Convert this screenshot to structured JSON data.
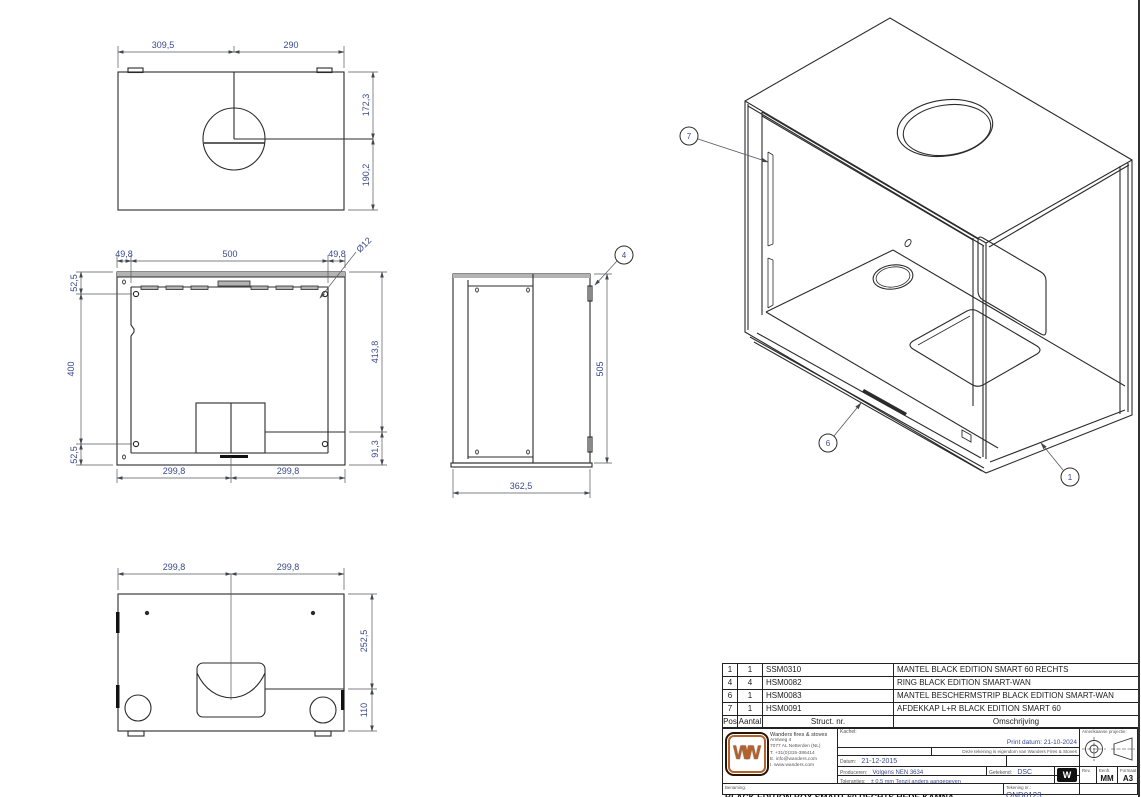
{
  "views": {
    "top": {
      "w_left": "309,5",
      "w_right": "290",
      "h_top": "172,3",
      "h_bottom": "190,2"
    },
    "front": {
      "top_left": "49,8",
      "top_center": "500",
      "top_right": "49,8",
      "hole": "Ø12",
      "left_top": "52,5",
      "left_mid": "400",
      "left_bottom": "52,5",
      "right_top": "413,8",
      "right_bottom": "91,3",
      "bottom_left": "299,8",
      "bottom_right": "299,8"
    },
    "side": {
      "height": "505",
      "width": "362,5",
      "callout_4": "4"
    },
    "bottom": {
      "top_left": "299,8",
      "top_right": "299,8",
      "right_top": "252,5",
      "right_bottom": "110"
    },
    "iso": {
      "callout_7": "7",
      "callout_6": "6",
      "callout_1": "1"
    }
  },
  "parts_table": {
    "headers": {
      "pos": "Pos",
      "qty": "Aantal",
      "struct": "Struct. nr.",
      "desc": "Omschrijving"
    },
    "rows": [
      {
        "pos": "1",
        "qty": "1",
        "struct": "SSM0310",
        "desc": "MANTEL BLACK EDITION SMART 60 RECHTS"
      },
      {
        "pos": "4",
        "qty": "4",
        "struct": "HSM0082",
        "desc": "RING BLACK EDITION SMART-WAN"
      },
      {
        "pos": "6",
        "qty": "1",
        "struct": "HSM0083",
        "desc": "MANTEL BESCHERMSTRIP BLACK EDITION SMART-WAN"
      },
      {
        "pos": "7",
        "qty": "1",
        "struct": "HSM0091",
        "desc": "AFDEKKAP L+R BLACK EDITION SMART 60"
      }
    ]
  },
  "title_block": {
    "company": {
      "name": "Wanders fires & stoves",
      "address1": "Amtweg 4",
      "address2": "7077 AL Netterden (NL)",
      "phone": "T. +31(0)315-386414",
      "email": "E. info@wanders.com",
      "web": "I. www.wanders.com",
      "logo_text": "WW"
    },
    "kachel_label": "Kachel:",
    "print_date": "Print datum: 21-10-2024",
    "ownership": "Deze tekening is eigendom van Wanders Fires & Stoves",
    "datum_label": "Datum:",
    "datum_value": "21-12-2015",
    "produceren_label": "Produceren:",
    "produceren_value": "Volgens NEN 3634",
    "getekend_label": "Getekend:",
    "getekend_value": "DSC",
    "toleranties_label": "Toleranties:",
    "toleranties_value": "± 0.5 mm Tenzij anders aangegeven",
    "benaming_label": "Benaming:",
    "benaming_value": "BLACK EDITION BOX SMART 60 RECHTS HEDE KAMNA",
    "tekening_label": "Tekening nr.:",
    "tekening_value": "OND0123",
    "projection_label": "Amerikaanse projectie:",
    "rev_label": "Rev.",
    "unit_label": "Eenh.",
    "unit_value": "MM",
    "format_label": "Formaat",
    "format_value": "A3",
    "small_logo_text": "W"
  },
  "colors": {
    "dim_text": "#3A4A8F",
    "line": "#2B2B2B",
    "logo_orange": "#B4622D"
  }
}
